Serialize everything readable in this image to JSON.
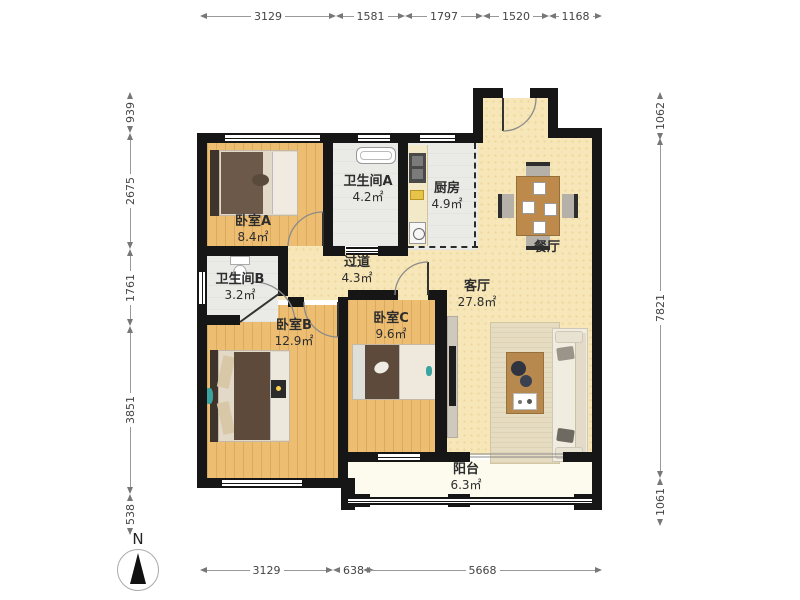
{
  "plan": {
    "compass_label": "N",
    "rooms": {
      "bedroom_a": {
        "name": "卧室A",
        "area": "8.4㎡"
      },
      "bathroom_a": {
        "name": "卫生间A",
        "area": "4.2㎡"
      },
      "kitchen": {
        "name": "厨房",
        "area": "4.9㎡"
      },
      "dining": {
        "name": "餐厅",
        "area": ""
      },
      "hallway": {
        "name": "过道",
        "area": "4.3㎡"
      },
      "bathroom_b": {
        "name": "卫生间B",
        "area": "3.2㎡"
      },
      "bedroom_b": {
        "name": "卧室B",
        "area": "12.9㎡"
      },
      "bedroom_c": {
        "name": "卧室C",
        "area": "9.6㎡"
      },
      "living": {
        "name": "客厅",
        "area": "27.8㎡"
      },
      "balcony": {
        "name": "阳台",
        "area": "6.3㎡"
      }
    },
    "dimensions": {
      "top": [
        "3129",
        "1581",
        "1797",
        "1520",
        "1168"
      ],
      "left": [
        "939",
        "2675",
        "1761",
        "3851",
        "538"
      ],
      "right": [
        "1062",
        "7821",
        "1061"
      ],
      "bottom": [
        "3129",
        "638",
        "5668"
      ]
    },
    "colors": {
      "wall": "#161616",
      "wood_floor": "#EDBE72",
      "tile_floor": "#EAEAE7",
      "living_floor": "#F6E6B8",
      "balcony_floor": "#FDFBEE"
    }
  }
}
